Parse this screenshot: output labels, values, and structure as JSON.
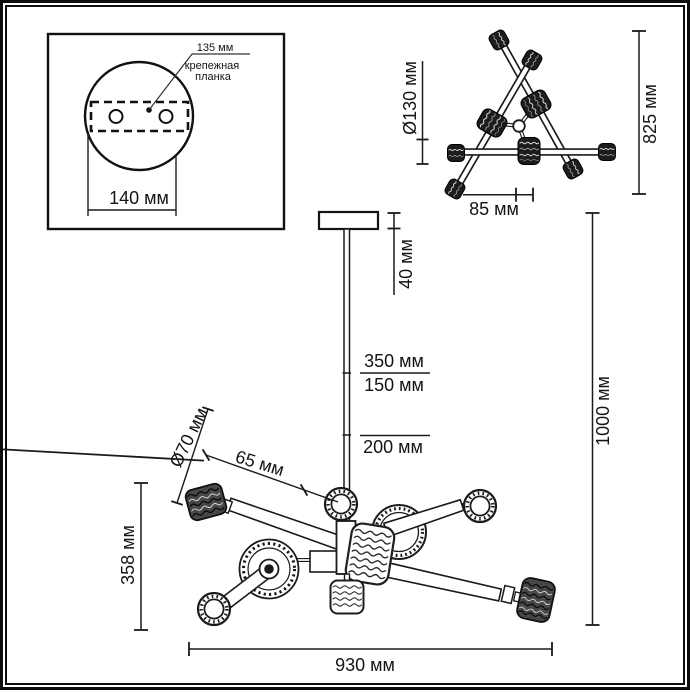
{
  "inset": {
    "plate_width_label": "135 мм",
    "plate_name_line1": "крепежная",
    "plate_name_line2": "планка",
    "canopy_width_label": "140 мм"
  },
  "top_view": {
    "shade_diameter_label": "Ø130 мм",
    "overall_width_label": "825 мм",
    "center_offset_label": "85 мм"
  },
  "side_view": {
    "canopy_height_label": "40 мм",
    "rod_segment_top_label": "350 мм",
    "rod_segment_mid_label": "150 мм",
    "rod_segment_bottom_label": "200 мм",
    "overall_height_label": "1000 мм",
    "shade_diameter_label": "Ø70 мм",
    "shade_offset_label": "65 мм",
    "body_height_label": "358 мм",
    "body_width_label": "930 мм"
  },
  "colors": {
    "ink": "#1a1a1a",
    "paper": "#ffffff"
  }
}
